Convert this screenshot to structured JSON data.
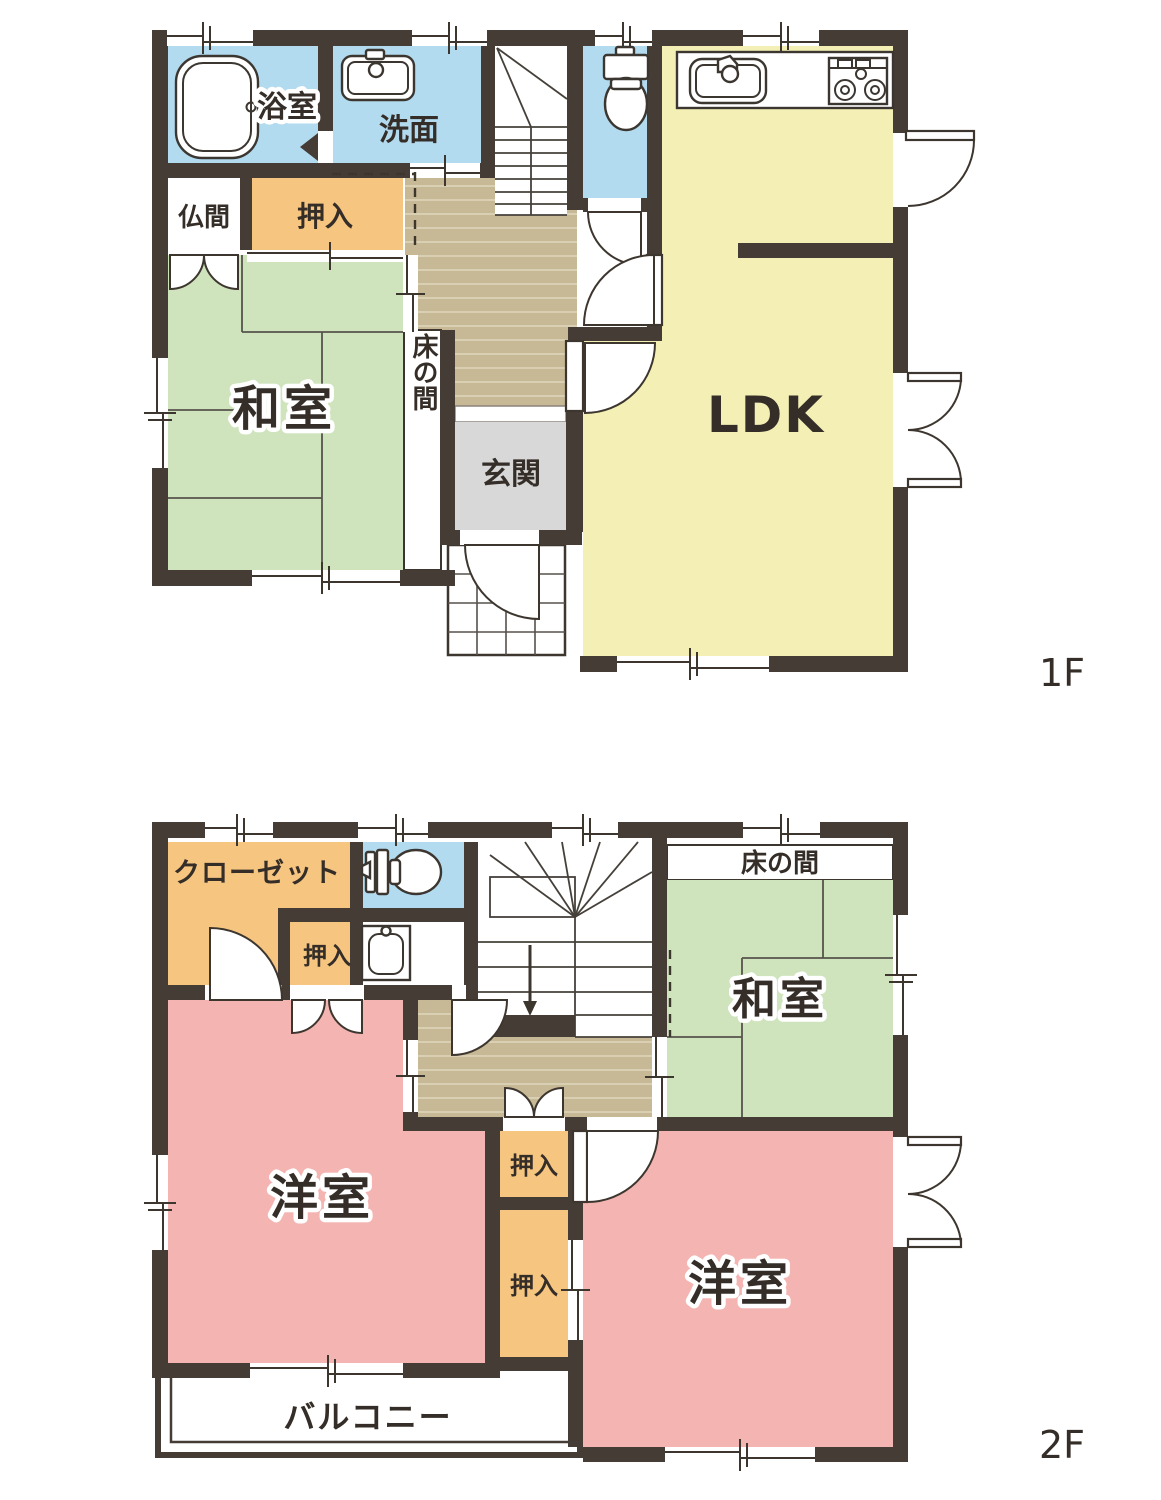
{
  "document": {
    "type": "floor-plan",
    "floors_shown": 2
  },
  "colors": {
    "wall": "#453c35",
    "water_rooms_blue": "#b3dbf0",
    "closet_orange": "#f6c580",
    "tatami_green": "#cfe4bd",
    "ldk_yellow": "#f4f0b5",
    "western_room_pink": "#f4b5b2",
    "hall_wood_tan": "#c7b995",
    "hall_wood_line": "#d9cfb2",
    "entrance_gray": "#d8d8d8",
    "line_dark": "#3d362f",
    "label_text": "#352e28"
  },
  "labels": {
    "bath": "浴室",
    "washroom": "洗面",
    "butsuma": "仏間",
    "oshiire": "押入",
    "washitsu": "和室",
    "tokonoma": "床の間",
    "genkan": "玄関",
    "ldk": "LDK",
    "closet": "クローゼット",
    "youshitsu": "洋室",
    "balcony": "バルコニー",
    "floor1": "1F",
    "floor2": "2F"
  },
  "floors": {
    "f1": {
      "tag": "1F",
      "rooms": [
        "浴室",
        "洗面",
        "仏間",
        "押入",
        "和室",
        "床の間",
        "玄関",
        "LDK"
      ],
      "fixtures": [
        "bathtub",
        "washbasin",
        "toilet",
        "kitchen-sink",
        "stove",
        "staircase",
        "entrance-porch"
      ]
    },
    "f2": {
      "tag": "2F",
      "rooms": [
        "クローゼット",
        "押入",
        "和室",
        "床の間",
        "洋室",
        "洋室",
        "押入",
        "押入",
        "バルコニー"
      ],
      "fixtures": [
        "toilet",
        "washbasin",
        "staircase",
        "balcony"
      ]
    }
  }
}
